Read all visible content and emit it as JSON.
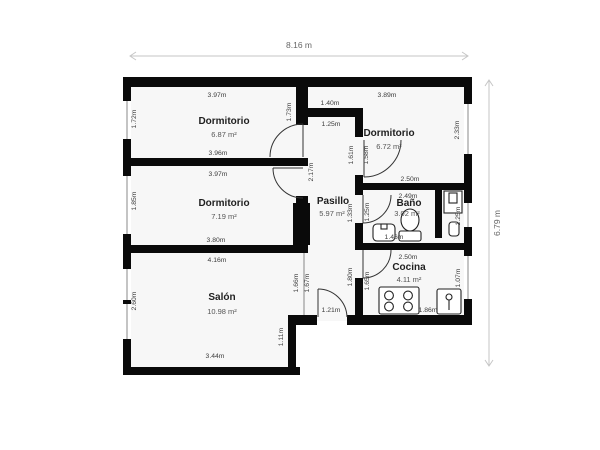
{
  "plan": {
    "overall": {
      "width": "8.16 m",
      "height": "6.79 m"
    },
    "rooms": {
      "dormitorio1": {
        "name": "Dormitorio",
        "area": "6.87 m²"
      },
      "dormitorio2": {
        "name": "Dormitorio",
        "area": "7.19 m²"
      },
      "dormitorio3": {
        "name": "Dormitorio",
        "area": "6.72 m²"
      },
      "pasillo": {
        "name": "Pasillo",
        "area": "5.97 m²"
      },
      "bano": {
        "name": "Baño",
        "area": "3.02 m²"
      },
      "cocina": {
        "name": "Cocina",
        "area": "4.11 m²"
      },
      "salon": {
        "name": "Salón",
        "area": "10.98 m²"
      }
    },
    "dims": {
      "d1_top": "3.97m",
      "d1_bottom": "3.96m",
      "d1_left": "1.72m",
      "d1_right": "1.73m",
      "d2_top": "3.97m",
      "d2_bottom": "3.80m",
      "d2_left": "1.85m",
      "d2_right": "2.17m",
      "d3_top": "3.89m",
      "d3_left_hall": "1.61m",
      "d3_left_in": "1.58m",
      "d3_right": "2.33m",
      "d3_bottom": "2.50m",
      "notch_top": "1.40m",
      "notch_bottom": "1.25m",
      "bano_top": "2.49m",
      "bano_left": "1.25m",
      "bano_window": "1.25m",
      "bano_fixture": "1.46m",
      "hall_mid": "1.33m",
      "hall_bottom": "1.80m",
      "cocina_top": "2.50m",
      "cocina_left": "1.65m",
      "cocina_window": "1.07m",
      "cocina_counter": "1.86m",
      "salon_top": "4.16m",
      "salon_bottom": "3.44m",
      "salon_left": "2.60m",
      "salon_right_a": "1.66m",
      "salon_right_b": "1.67m",
      "salon_step": "1.11m",
      "entry_door": "1.21m"
    },
    "colors": {
      "wall": "#0a0a0a",
      "room_fill": "#f7f7f7",
      "dim_text": "#3c3c3c"
    }
  }
}
